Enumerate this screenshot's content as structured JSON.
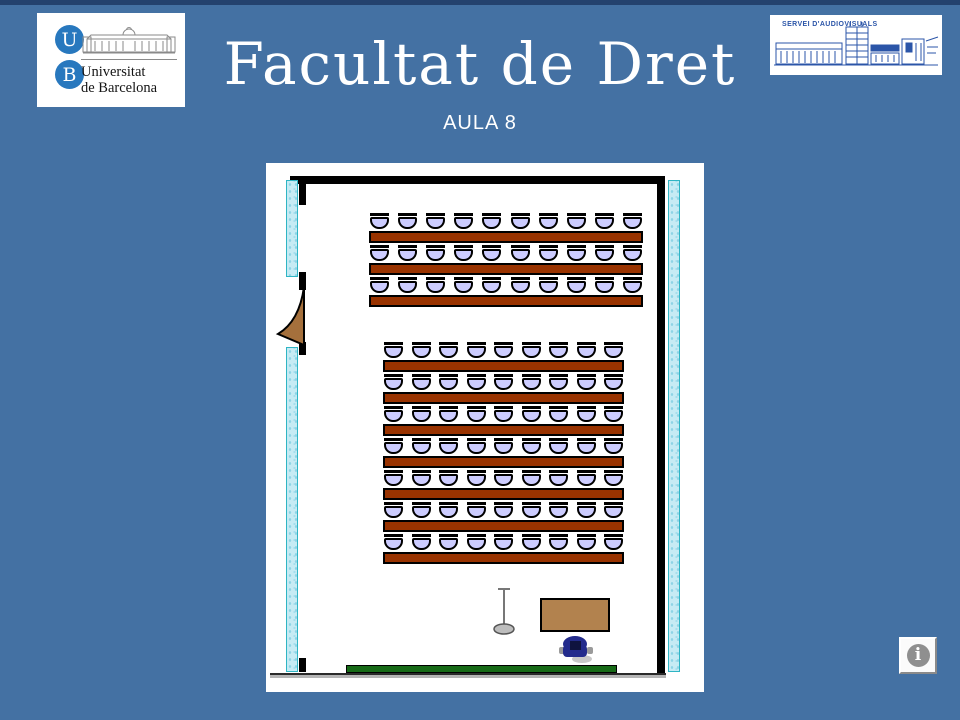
{
  "slide": {
    "title": "Facultat de Dret",
    "subtitle": "AULA 8",
    "background_color": "#4471A3",
    "top_band_color": "#24426E"
  },
  "header": {
    "ub_logo": {
      "circle_letter_top": "U",
      "circle_letter_bottom": "B",
      "name_line1": "Universitat",
      "name_line2": "de Barcelona",
      "circle_color": "#2878BE"
    },
    "av_logo": {
      "label": "SERVEI D'AUDIOVISUALS",
      "ink_color": "#2B55A8"
    }
  },
  "room": {
    "seat_blocks": [
      {
        "name": "back-block",
        "rows": 3,
        "seats_per_row": 10
      },
      {
        "name": "main-block",
        "rows": 7,
        "seats_per_row": 9
      }
    ],
    "total_seats": 93,
    "furniture_icons": [
      "microphone-stand-icon",
      "teacher-table",
      "teacher-chair-icon",
      "blackboard"
    ],
    "colors": {
      "desk": "#993300",
      "chair_fill": "#CCCCFF",
      "side_wall_fill": "#C6EBF4",
      "side_wall_border": "#2FB5C4",
      "door": "#A5703C",
      "teacher_table": "#B2824E",
      "teacher_chair": "#232B8C",
      "board": "#176A17"
    }
  },
  "info_button": {
    "symbol": "i"
  }
}
